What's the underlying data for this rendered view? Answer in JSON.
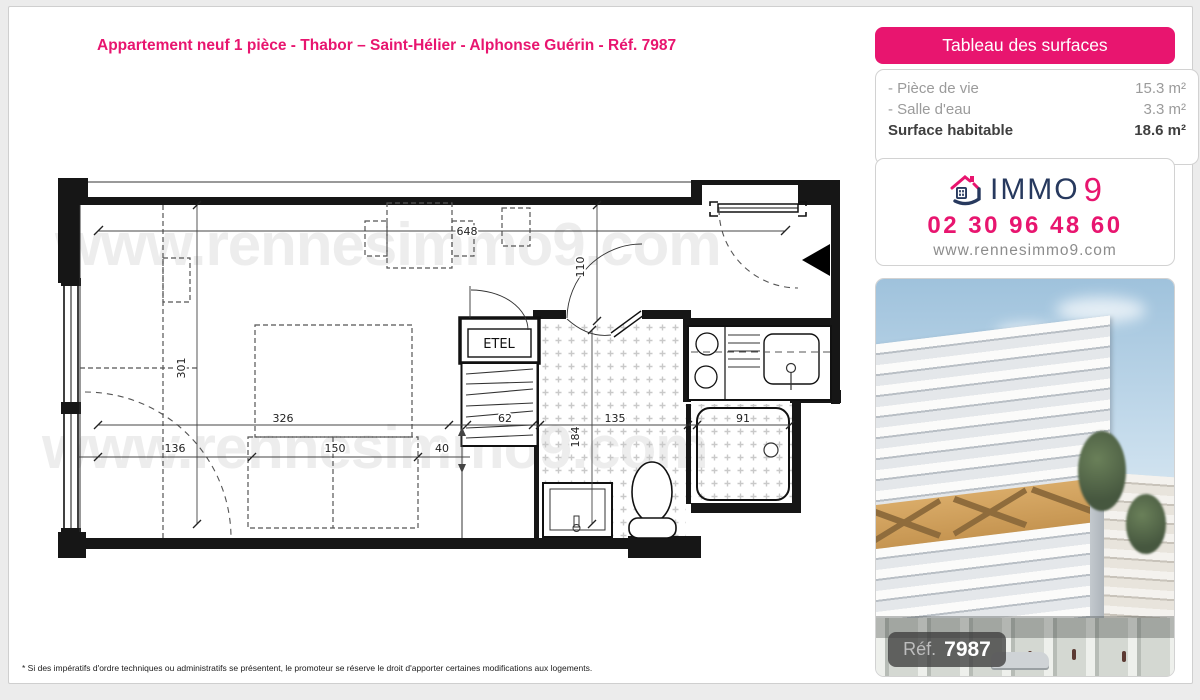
{
  "page": {
    "title": "Appartement neuf 1 pièce - Thabor – Saint-Hélier - Alphonse Guérin - Réf. 7987",
    "footnote": "* Si des impératifs d'ordre techniques ou administratifs se présentent, le promoteur se réserve le droit d'apporter certaines modifications aux logements.",
    "watermark": "www.rennesimmo9.com"
  },
  "surface_table": {
    "header": "Tableau des surfaces",
    "rows": [
      {
        "label": "- Pièce de vie",
        "value": "15.3 m²"
      },
      {
        "label": "- Salle d'eau",
        "value": "3.3 m²"
      }
    ],
    "total": {
      "label": "Surface habitable",
      "value": "18.6 m²"
    }
  },
  "agency": {
    "brand": "IMMO",
    "brand_digit": "9",
    "phone": "02 30 96 48 60",
    "website": "www.rennesimmo9.com"
  },
  "photo": {
    "ref_label": "Réf.",
    "ref_value": "7987"
  },
  "floor_plan": {
    "labels": {
      "etel": "ETEL"
    },
    "dims": {
      "d648": "648",
      "d110": "110",
      "d301": "301",
      "d326": "326",
      "d136": "136",
      "d150": "150",
      "d40": "40",
      "d62": "62",
      "d184": "184",
      "d135": "135",
      "d91": "91"
    }
  },
  "colors": {
    "brand_pink": "#e8156f",
    "brand_navy": "#27395e"
  }
}
